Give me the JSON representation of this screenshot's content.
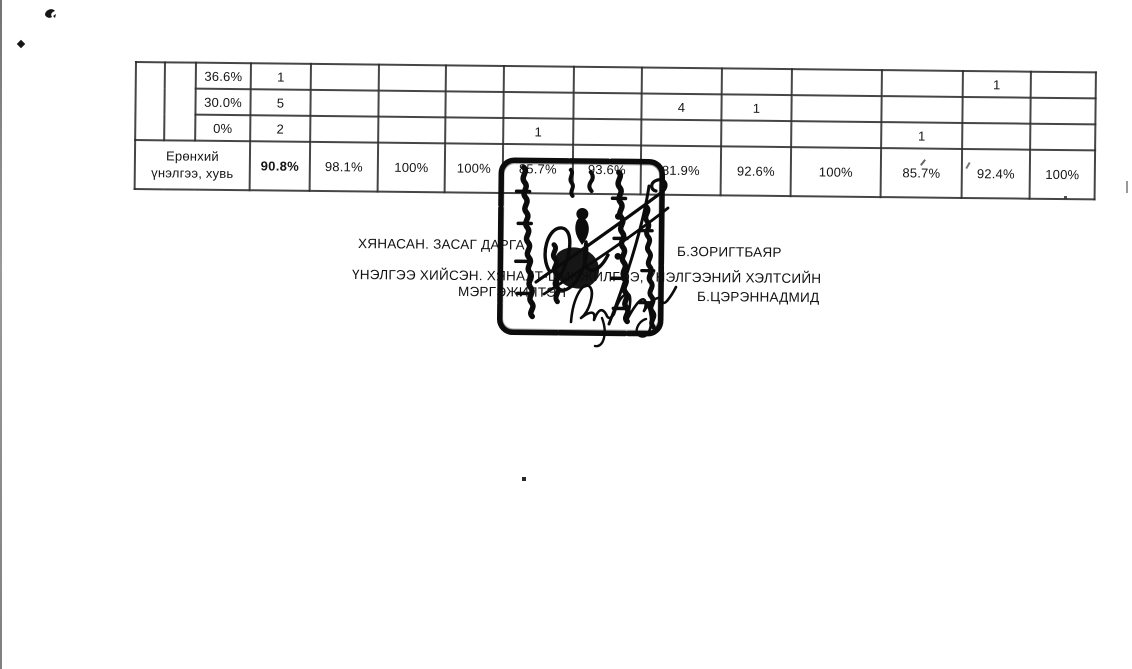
{
  "page": {
    "background": "#ffffff",
    "ink_color": "#141414"
  },
  "table": {
    "rows": [
      {
        "label": "36.6%",
        "cells": [
          "1",
          "",
          "",
          "",
          "",
          "",
          "",
          "",
          "",
          "",
          "1",
          ""
        ]
      },
      {
        "label": "30.0%",
        "cells": [
          "5",
          "",
          "",
          "",
          "",
          "",
          "4",
          "1",
          "",
          "",
          "",
          ""
        ]
      },
      {
        "label": "0%",
        "cells": [
          "2",
          "",
          "",
          "",
          "1",
          "",
          "",
          "",
          "",
          "1",
          "",
          ""
        ]
      },
      {
        "label": "Ерөнхий үнэлгээ, хувь",
        "cells": [
          "90.8%",
          "98.1%",
          "100%",
          "100%",
          "85.7%",
          "93.6%",
          "81.9%",
          "92.6%",
          "100%",
          "85.7%",
          "92.4%",
          "100%"
        ]
      }
    ]
  },
  "signatures": {
    "reviewed_by_label": "ХЯНАСАН. ЗАСАГ ДАРГА",
    "reviewed_by_name": "Б.ЗОРИГТБАЯР",
    "evaluated_by_label_line1": "ҮНЭЛГЭЭ ХИЙСЭН. ХЯНАЛТ-ШИНЖИЛГЭЭ, ҮНЭЛГЭЭНИЙ ХЭЛТСИЙН",
    "evaluated_by_label_line2": "МЭРГЭЖИЛТЭН",
    "evaluated_by_name": "Б.ЦЭРЭННАДМИД"
  },
  "stamp": {
    "shape": "rounded-square-seal",
    "ink_color": "#0c0c0c"
  }
}
